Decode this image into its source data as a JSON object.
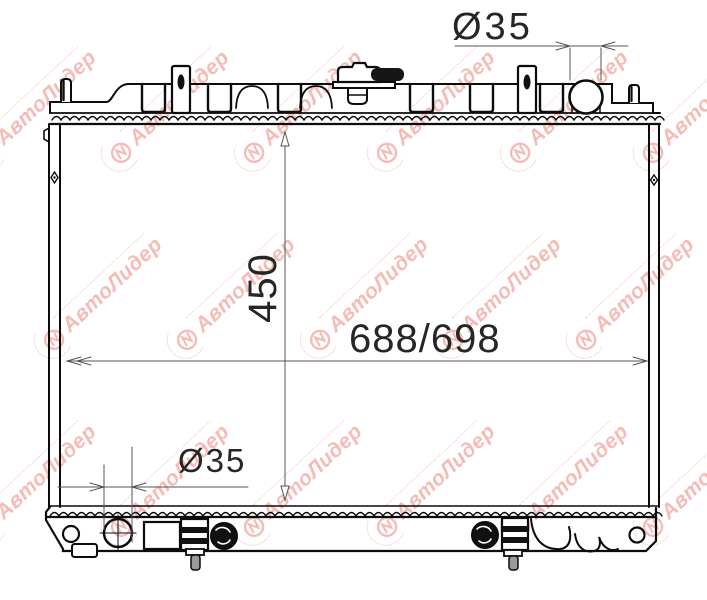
{
  "dimension_labels": {
    "top_diameter": "Ø35",
    "height": "450",
    "width": "688/698",
    "bottom_diameter": "Ø35"
  },
  "watermark": {
    "text": "АвтоЛидер",
    "color": "#ef928c"
  },
  "drawing_colors": {
    "outline": "#0c0c0c",
    "dimension_lines": "#555555"
  }
}
